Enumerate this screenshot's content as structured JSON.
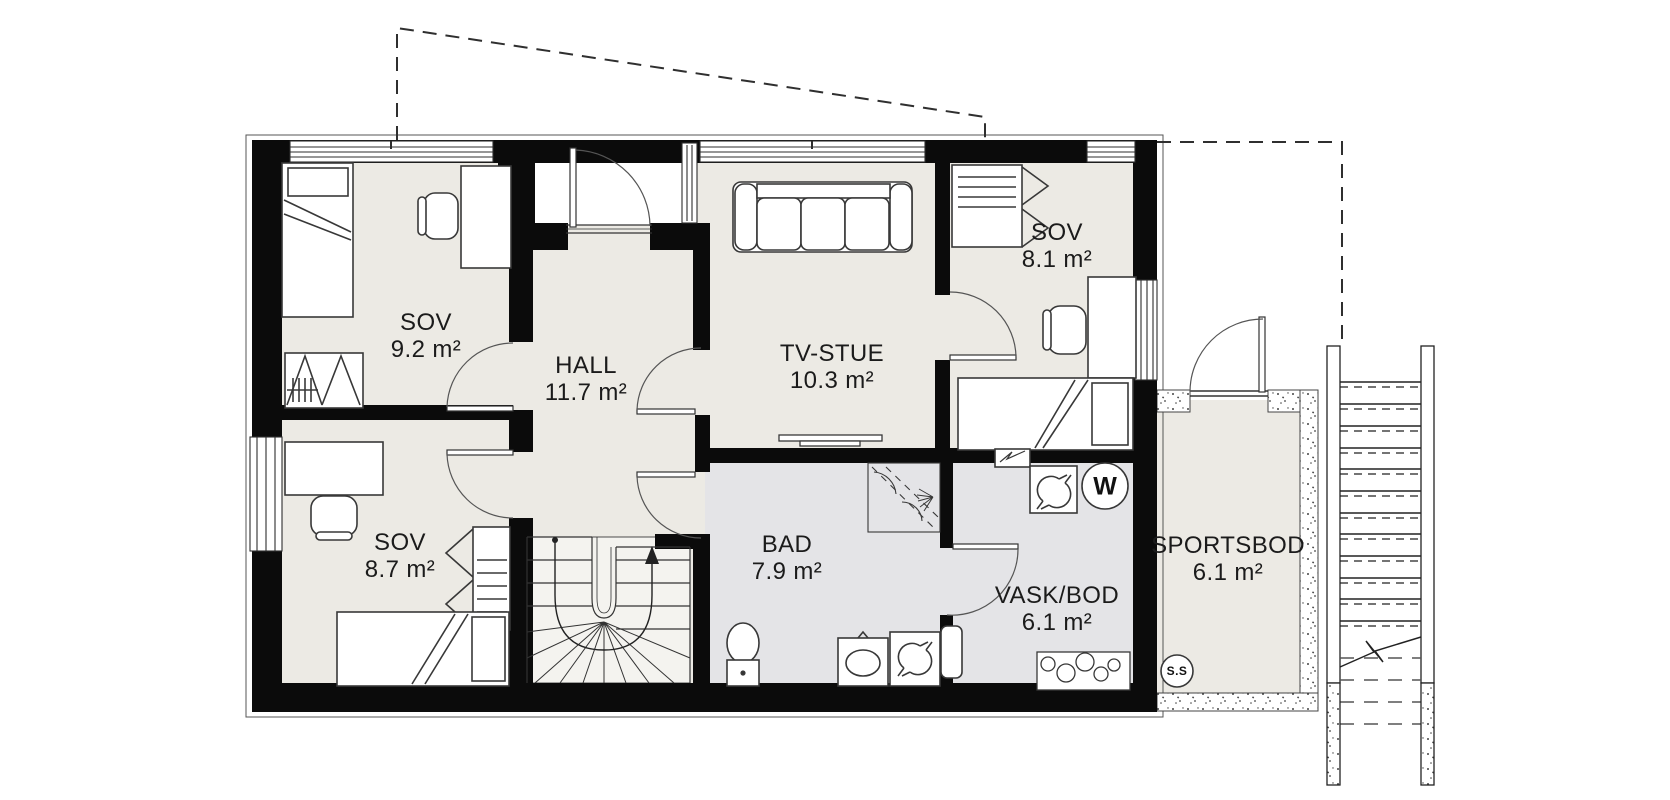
{
  "plan": {
    "type": "architectural-floor-plan",
    "rooms": [
      {
        "name": "SOV",
        "area": "9.2 m²"
      },
      {
        "name": "HALL",
        "area": "11.7 m²"
      },
      {
        "name": "TV-STUE",
        "area": "10.3 m²"
      },
      {
        "name": "SOV",
        "area": "8.1 m²"
      },
      {
        "name": "SOV",
        "area": "8.7 m²"
      },
      {
        "name": "BAD",
        "area": "7.9 m²"
      },
      {
        "name": "VASK/BOD",
        "area": "6.1 m²"
      },
      {
        "name": "SPORTSBOD",
        "area": "6.1 m²"
      }
    ],
    "badges": [
      {
        "label": "W"
      },
      {
        "label": "S.S"
      }
    ],
    "colors": {
      "wall": "#0b0b0b",
      "floor": "#eceae4",
      "wet_floor": "#e4e4e7",
      "stair_floor": "#f4f3ef",
      "outline": "#3a3a3a"
    },
    "icons": [
      "bed-icon",
      "desk-icon",
      "chair-icon",
      "wardrobe-icon",
      "sofa-icon",
      "tv-bench-icon",
      "shower-icon",
      "toilet-icon",
      "sink-icon",
      "washing-machine-icon",
      "laundry-sink-icon",
      "fuse-box-icon",
      "winder-stairs-icon",
      "exterior-stairs-icon",
      "door-swing-icon",
      "window-icon",
      "roof-outline-icon"
    ]
  }
}
